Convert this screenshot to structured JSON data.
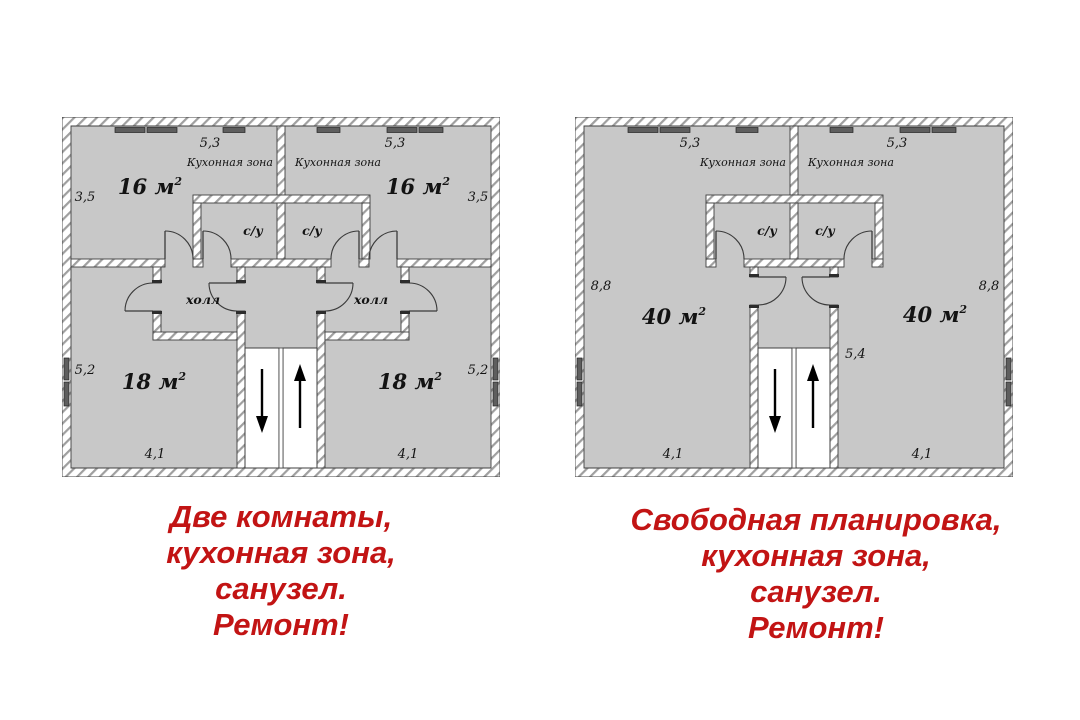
{
  "colors": {
    "caption-red": "#c21414",
    "room-fill": "#c8c8c8",
    "wall-line": "#3f3f3f",
    "window-fill": "#5e5e5e"
  },
  "left_plan": {
    "top_dims": [
      "5,3",
      "5,3"
    ],
    "kitchen_zones": [
      "Кухонная зона",
      "Кухонная зона"
    ],
    "upper_rooms": [
      {
        "area": "16 м",
        "sup": "2"
      },
      {
        "area": "16 м",
        "sup": "2"
      }
    ],
    "upper_side_dims": [
      "3,5",
      "3,5"
    ],
    "bathrooms": [
      "с/у",
      "с/у"
    ],
    "halls": [
      "холл",
      "холл"
    ],
    "lower_rooms": [
      {
        "area": "18 м",
        "sup": "2"
      },
      {
        "area": "18 м",
        "sup": "2"
      }
    ],
    "lower_side_dims": [
      "5,2",
      "5,2"
    ],
    "bottom_dims": [
      "4,1",
      "4,1"
    ]
  },
  "right_plan": {
    "top_dims": [
      "5,3",
      "5,3"
    ],
    "kitchen_zones": [
      "Кухонная зона",
      "Кухонная зона"
    ],
    "side_dims": [
      "8,8",
      "8,8"
    ],
    "bathrooms": [
      "с/у",
      "с/у"
    ],
    "rooms": [
      {
        "area": "40 м",
        "sup": "2"
      },
      {
        "area": "40 м",
        "sup": "2"
      }
    ],
    "stair_dim": "5,4",
    "bottom_dims": [
      "4,1",
      "4,1"
    ]
  },
  "left_caption": {
    "lines": [
      "Две комнаты,",
      "кухонная зона,",
      "санузел.",
      "Ремонт!"
    ]
  },
  "right_caption": {
    "lines": [
      "Свободная планировка,",
      "кухонная зона,",
      "санузел.",
      "Ремонт!"
    ]
  }
}
